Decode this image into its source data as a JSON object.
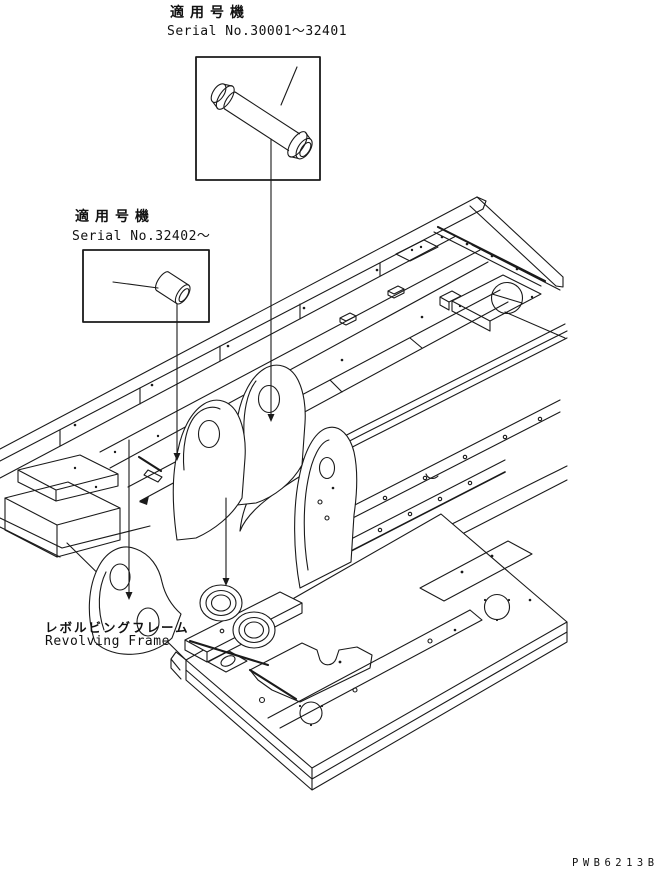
{
  "page": {
    "background": "#ffffff",
    "line_color": "#1a1a1a"
  },
  "callouts": {
    "pin": {
      "applicability": "適用号機",
      "serial_range": "Serial No.30001～32401"
    },
    "bushing": {
      "applicability": "適用号機",
      "serial_range": "Serial No.32402～"
    }
  },
  "frame": {
    "label_jp": "レボルビングフレーム",
    "label_en": "Revolving Frame"
  },
  "drawing_number": "PWB6213B"
}
